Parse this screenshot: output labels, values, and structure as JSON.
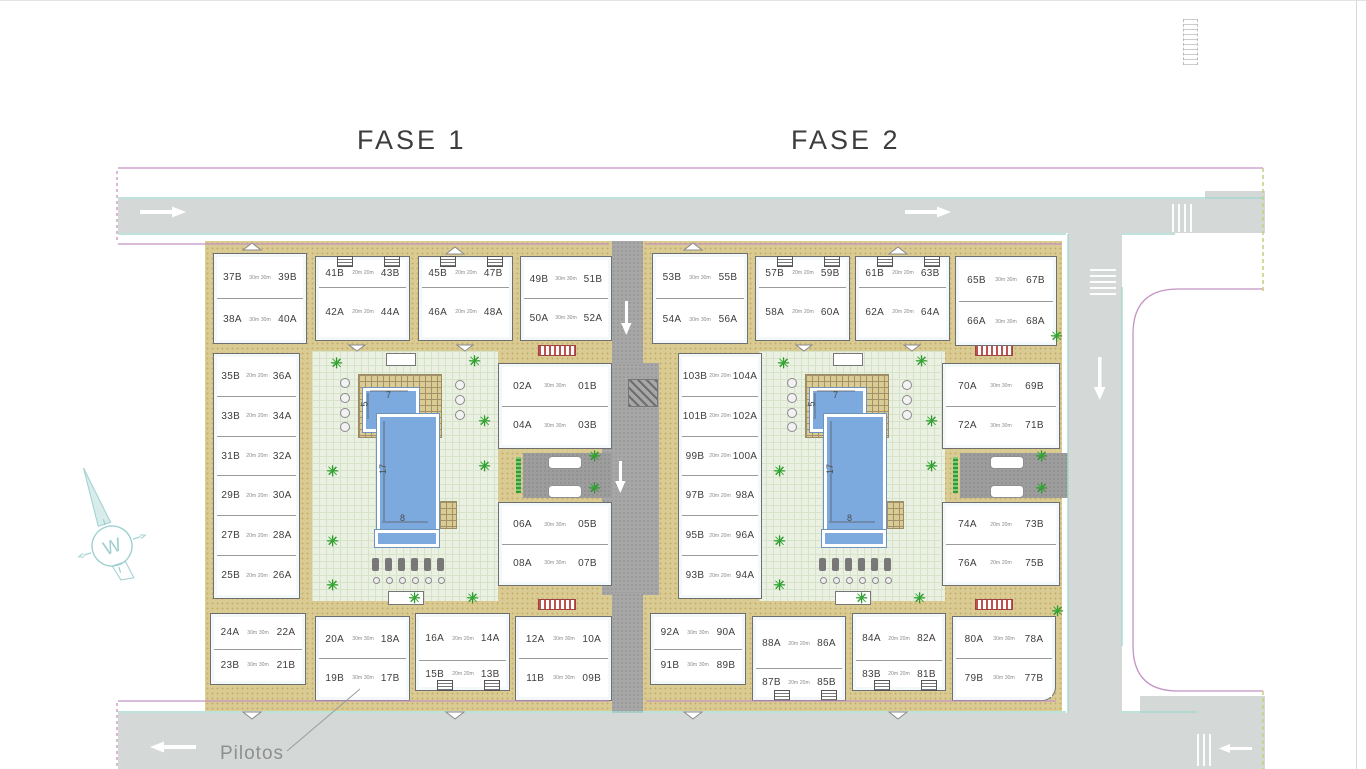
{
  "titles": {
    "fase1": "FASE 1",
    "fase2": "FASE 2"
  },
  "annotations": {
    "pilotos_label": "Pilotos",
    "compass_letter": "W"
  },
  "pool_dimensions": {
    "small_pool_width": "5",
    "small_pool_length": "7",
    "large_pool_length": "17",
    "large_pool_width": "8"
  },
  "colors": {
    "road_gray": "#d4d9d8",
    "asphalt_gray": "#a7a7a7",
    "walkway_tan": "#d9cb92",
    "courtyard_green": "#eaf1e3",
    "pool_blue": "#7caade",
    "boundary_magenta": "#c493c4",
    "curb_cyan": "#a8d8d0",
    "palm_green": "#2fae2f",
    "crosswalk_red": "#c0504d"
  },
  "blocks": [
    {
      "id": "f1-b37",
      "area": "30m",
      "rows": [
        [
          "37B",
          "39B"
        ],
        [
          "38A",
          "40A"
        ]
      ]
    },
    {
      "id": "f1-b41",
      "area": "20m",
      "rows": [
        [
          "41B",
          "43B"
        ],
        [
          "42A",
          "44A"
        ]
      ]
    },
    {
      "id": "f1-b45",
      "area": "20m",
      "rows": [
        [
          "45B",
          "47B"
        ],
        [
          "46A",
          "48A"
        ]
      ]
    },
    {
      "id": "f1-b49",
      "area": "30m",
      "rows": [
        [
          "49B",
          "51B"
        ],
        [
          "50A",
          "52A"
        ]
      ]
    },
    {
      "id": "f1-left",
      "area": "20m",
      "rows": [
        [
          "35B",
          "36A"
        ],
        [
          "33B",
          "34A"
        ],
        [
          "31B",
          "32A"
        ],
        [
          "29B",
          "30A"
        ],
        [
          "27B",
          "28A"
        ],
        [
          "25B",
          "26A"
        ]
      ]
    },
    {
      "id": "f1-mid-top",
      "area": "30m",
      "rows": [
        [
          "02A",
          "01B"
        ],
        [
          "04A",
          "03B"
        ]
      ]
    },
    {
      "id": "f1-mid-bot",
      "area": "30m",
      "rows": [
        [
          "06A",
          "05B"
        ],
        [
          "08A",
          "07B"
        ]
      ]
    },
    {
      "id": "f1-b24",
      "area": "30m",
      "rows": [
        [
          "24A",
          "22A"
        ],
        [
          "23B",
          "21B"
        ]
      ]
    },
    {
      "id": "f1-b20",
      "area": "30m",
      "rows": [
        [
          "20A",
          "18A"
        ],
        [
          "19B",
          "17B"
        ]
      ]
    },
    {
      "id": "f1-b16",
      "area": "20m",
      "rows": [
        [
          "16A",
          "14A"
        ],
        [
          "15B",
          "13B"
        ]
      ]
    },
    {
      "id": "f1-b12",
      "area": "30m",
      "rows": [
        [
          "12A",
          "10A"
        ],
        [
          "11B",
          "09B"
        ]
      ]
    },
    {
      "id": "f2-b53",
      "area": "30m",
      "rows": [
        [
          "53B",
          "55B"
        ],
        [
          "54A",
          "56A"
        ]
      ]
    },
    {
      "id": "f2-b57",
      "area": "20m",
      "rows": [
        [
          "57B",
          "59B"
        ],
        [
          "58A",
          "60A"
        ]
      ]
    },
    {
      "id": "f2-b61",
      "area": "20m",
      "rows": [
        [
          "61B",
          "63B"
        ],
        [
          "62A",
          "64A"
        ]
      ]
    },
    {
      "id": "f2-b65",
      "area": "30m",
      "rows": [
        [
          "65B",
          "67B"
        ],
        [
          "66A",
          "68A"
        ]
      ]
    },
    {
      "id": "f2-left",
      "area": "20m",
      "rows": [
        [
          "103B",
          "104A"
        ],
        [
          "101B",
          "102A"
        ],
        [
          "99B",
          "100A"
        ],
        [
          "97B",
          "98A"
        ],
        [
          "95B",
          "96A"
        ],
        [
          "93B",
          "94A"
        ]
      ]
    },
    {
      "id": "f2-right-top",
      "area": "30m",
      "rows": [
        [
          "70A",
          "69B"
        ],
        [
          "72A",
          "71B"
        ]
      ]
    },
    {
      "id": "f2-right-bot",
      "area": "20m",
      "rows": [
        [
          "74A",
          "73B"
        ],
        [
          "76A",
          "75B"
        ]
      ]
    },
    {
      "id": "f2-b92",
      "area": "30m",
      "rows": [
        [
          "92A",
          "90A"
        ],
        [
          "91B",
          "89B"
        ]
      ]
    },
    {
      "id": "f2-b88",
      "area": "20m",
      "rows": [
        [
          "88A",
          "86A"
        ],
        [
          "87B",
          "85B"
        ]
      ]
    },
    {
      "id": "f2-b84",
      "area": "20m",
      "rows": [
        [
          "84A",
          "82A"
        ],
        [
          "83B",
          "81B"
        ]
      ]
    },
    {
      "id": "f2-b80",
      "area": "30m",
      "rows": [
        [
          "80A",
          "78A"
        ],
        [
          "79B",
          "77B"
        ]
      ]
    }
  ]
}
